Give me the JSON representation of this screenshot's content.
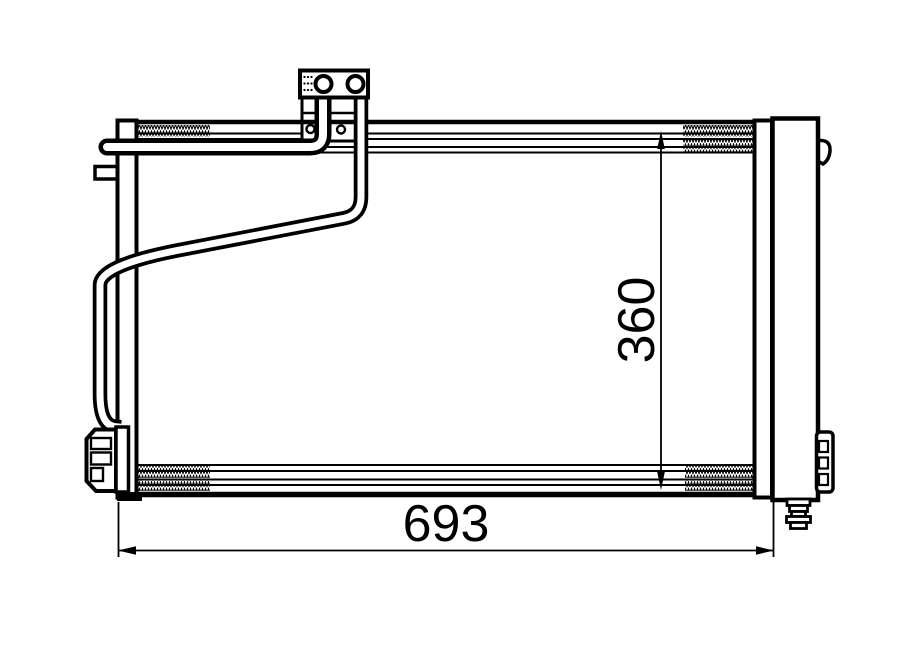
{
  "diagram": {
    "dimensions": {
      "width_label": "693",
      "height_label": "360"
    },
    "colors": {
      "line_color": "#000000",
      "background": "#ffffff"
    }
  }
}
